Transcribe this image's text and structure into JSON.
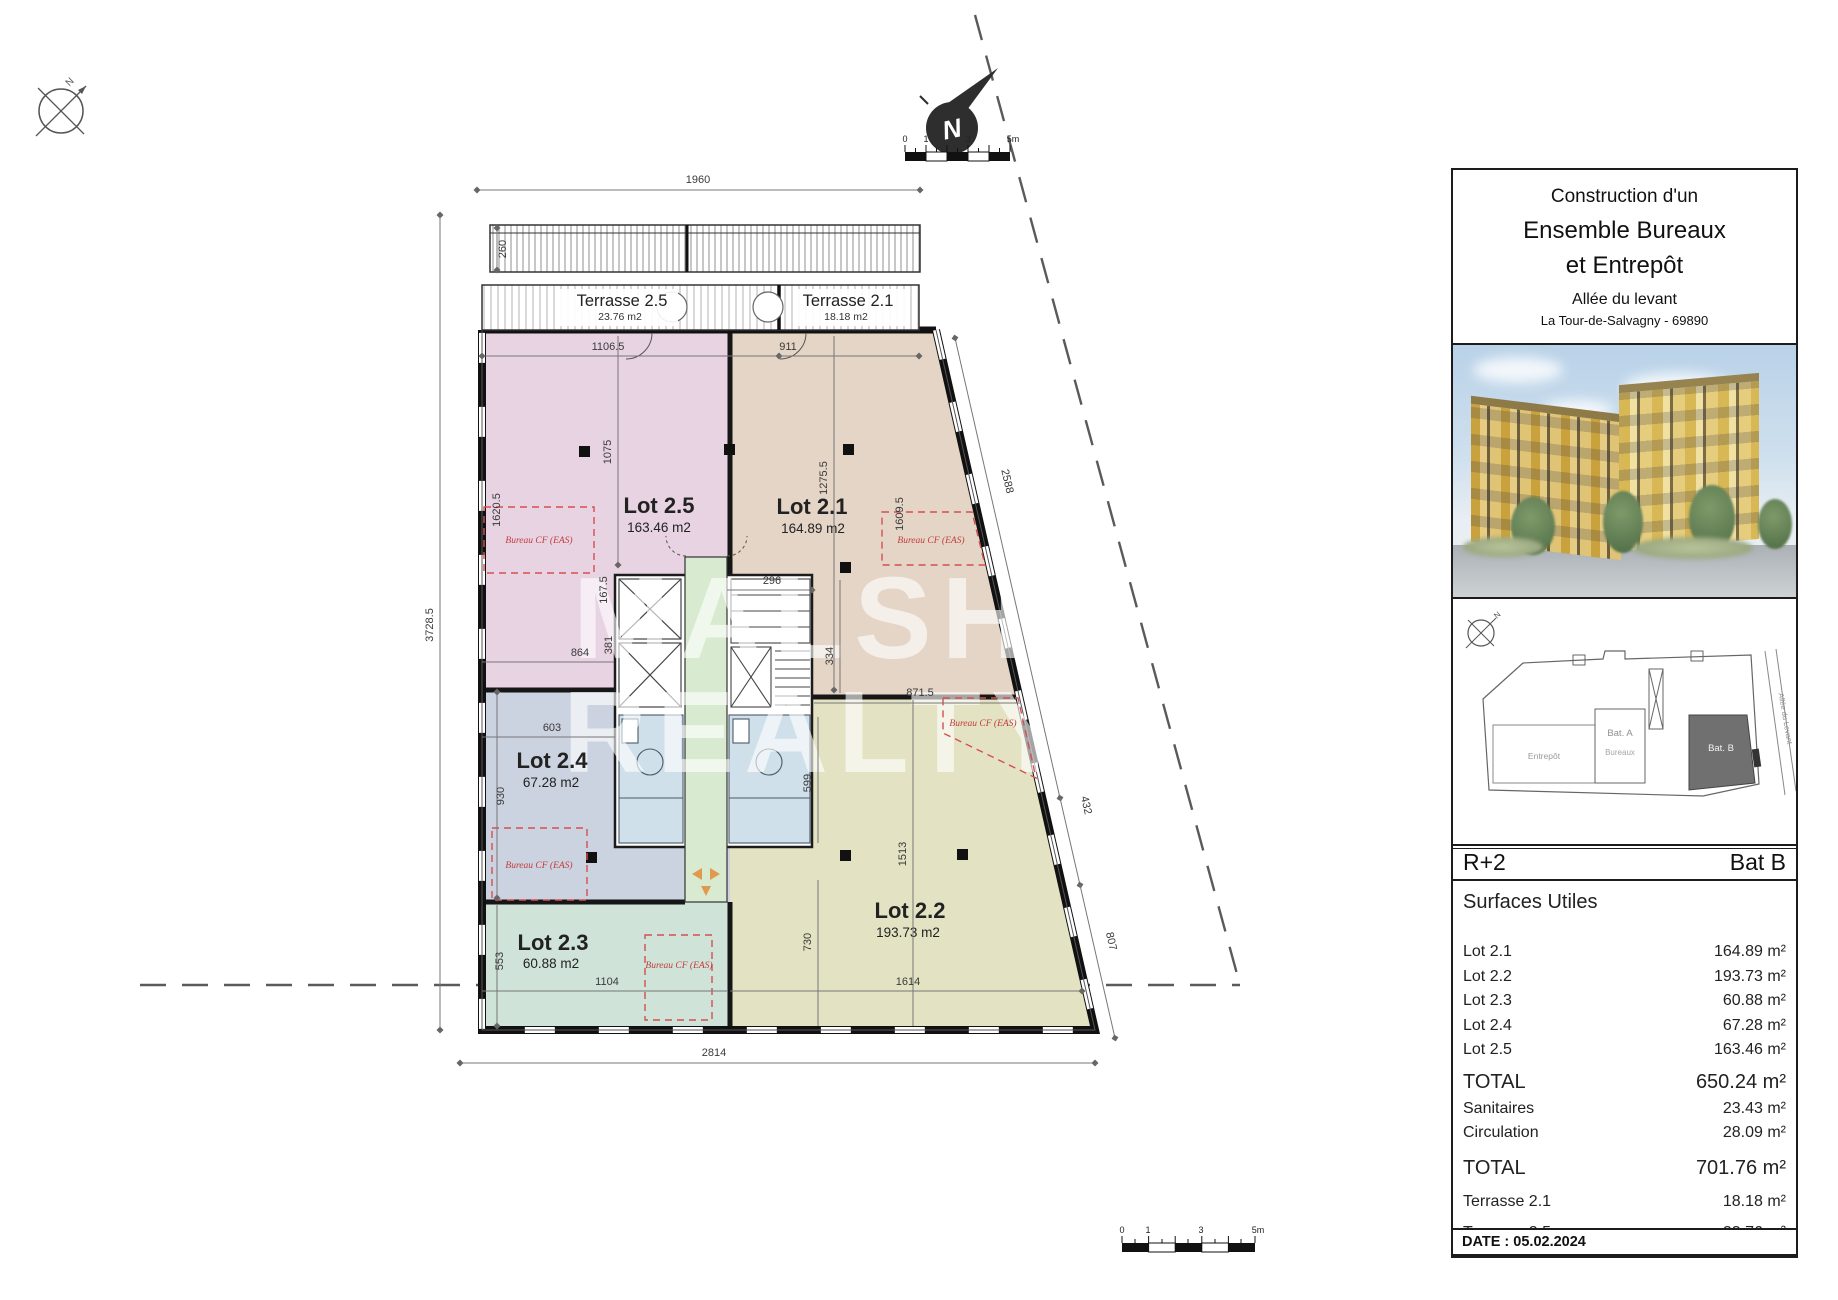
{
  "title_block": {
    "line1": "Construction d'un",
    "line2": "Ensemble Bureaux",
    "line3": "et Entrepôt",
    "line4": "Allée du levant",
    "line5": "La Tour-de-Salvagny - 69890"
  },
  "summary": {
    "floor": "R+2",
    "building": "Bat B",
    "section": "Surfaces Utiles",
    "rows": [
      {
        "label": "Lot 2.1",
        "value": "164.89 m²"
      },
      {
        "label": "Lot 2.2",
        "value": "193.73 m²"
      },
      {
        "label": "Lot 2.3",
        "value": "60.88 m²"
      },
      {
        "label": "Lot 2.4",
        "value": "67.28 m²"
      },
      {
        "label": "Lot 2.5",
        "value": "163.46 m²"
      },
      {
        "label": "TOTAL",
        "value": "650.24 m²"
      },
      {
        "label": "Sanitaires",
        "value": "23.43 m²"
      },
      {
        "label": "Circulation",
        "value": "28.09 m²"
      },
      {
        "label": "TOTAL",
        "value": "701.76 m²"
      },
      {
        "label": "Terrasse 2.1",
        "value": "18.18 m²"
      },
      {
        "label": "Terrasse 2.5",
        "value": "23.76 m²"
      }
    ],
    "date": "DATE : 05.02.2024"
  },
  "site_plan": {
    "entrepot": "Entrepôt",
    "bat_a": "Bat. A",
    "bureaux": "Bureaux",
    "bat_b": "Bat. B",
    "street": "Allée du Levant"
  },
  "plan": {
    "north_letter": "N",
    "watermark": {
      "line1": "MALSH",
      "line2": "REALTY"
    },
    "cf_label": "Bureau CF (EAS)",
    "lots": [
      {
        "name": "Lot 2.5",
        "area": "163.46 m2",
        "color": "#e8d3e3"
      },
      {
        "name": "Lot 2.1",
        "area": "164.89 m2",
        "color": "#e4d5c6"
      },
      {
        "name": "Lot 2.4",
        "area": "67.28 m2",
        "color": "#cbd2e0"
      },
      {
        "name": "Lot 2.3",
        "area": "60.88 m2",
        "color": "#cfe3d8"
      },
      {
        "name": "Lot 2.2",
        "area": "193.73 m2",
        "color": "#e3e3c3"
      }
    ],
    "terraces": [
      {
        "name": "Terrasse 2.5",
        "area": "23.76 m2"
      },
      {
        "name": "Terrasse 2.1",
        "area": "18.18 m2"
      }
    ],
    "dims": {
      "d1960": "1960",
      "d260": "260",
      "d1106_5": "1106.5",
      "d911": "911",
      "d3728_5": "3728.5",
      "d1075": "1075",
      "d1275_5": "1275.5",
      "d1620_5": "1620.5",
      "d1609_5": "1609.5",
      "d167_5": "167.5",
      "d864": "864",
      "d381": "381",
      "d296": "296",
      "d334": "334",
      "d603": "603",
      "d930": "930",
      "d553": "553",
      "d1104": "1104",
      "d2814": "2814",
      "d2588": "2588",
      "d432": "432",
      "d807": "807",
      "d871_5": "871.5",
      "d1513": "1513",
      "d1614": "1614",
      "d730": "730",
      "d599": "599"
    }
  },
  "scalebar": {
    "t0": "0",
    "t1": "1",
    "t3": "3",
    "t5": "5m"
  }
}
